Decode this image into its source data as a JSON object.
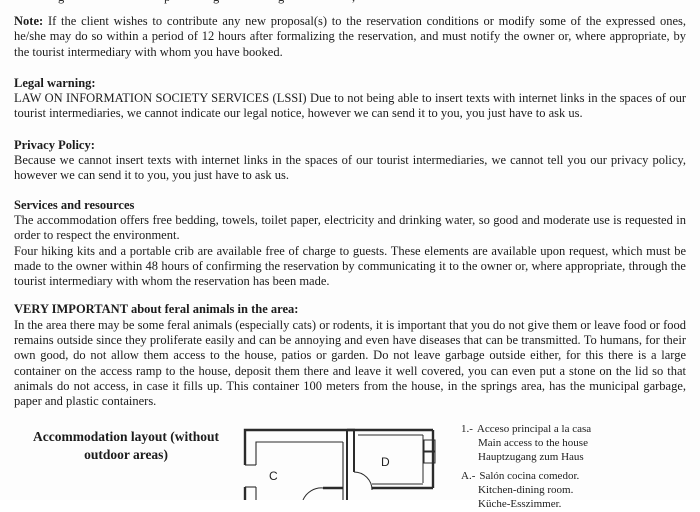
{
  "document": {
    "top_clipped_fragments": [
      "g",
      "p",
      "g",
      "g",
      ","
    ],
    "note": {
      "label": "Note:",
      "text": "If the client wishes to contribute any new proposal(s) to the reservation conditions or modify some of the expressed ones, he/she may do so within a period of 12 hours after formalizing the reservation, and must notify the owner or, where appropriate, by the tourist intermediary with whom you have booked."
    },
    "legal_warning": {
      "heading": "Legal warning:",
      "body": "LAW ON INFORMATION SOCIETY SERVICES (LSSI) Due to not being able to insert texts with internet links in the spaces of our tourist intermediaries, we cannot indicate our legal notice, however we can send it to you, you just have to ask us."
    },
    "privacy_policy": {
      "heading": "Privacy Policy:",
      "body": "Because we cannot insert texts with internet links in the spaces of our tourist intermediaries, we cannot tell you our privacy policy, however we can send it to you, you just have to ask us."
    },
    "services": {
      "heading": "Services and resources",
      "para1": "The accommodation offers free bedding, towels, toilet paper, electricity and drinking water, so good and moderate use is requested in order to respect the environment.",
      "para2": "Four hiking kits and a portable crib are available free of charge to guests. These elements are available upon request, which must be made to the owner within 48 hours of confirming the reservation by communicating it to the owner or, where appropriate, through the tourist intermediary with whom the reservation has been made."
    },
    "feral_animals": {
      "heading": "VERY IMPORTANT about feral animals in the area:",
      "body": "In the area there may be some feral animals (especially cats) or rodents, it is important that you do not give them or leave food or food remains outside since they proliferate easily and can be annoying and even have diseases that can be transmitted. To humans, for their own good, do not allow them access to the house, patios or garden. Do not leave garbage outside either, for this there is a large container on the access ramp to the house, deposit them there and leave it well covered, you can even put a stone on the lid so that animals do not access, in case it fills up. This container 100 meters from the house, in the springs area, has the municipal garbage, paper and plastic containers."
    },
    "layout_section": {
      "heading": "Accommodation layout (without outdoor areas)",
      "floor_plan": {
        "room_labels": {
          "c": "C",
          "d": "D"
        }
      },
      "legend": {
        "items": [
          {
            "key": "1.-",
            "lines": [
              "Acceso principal a la casa",
              "Main access to the house",
              "Hauptzugang zum Haus"
            ]
          },
          {
            "key": "A.-",
            "lines": [
              "Salón cocina comedor.",
              "Kitchen-dining room.",
              "Küche-Esszimmer."
            ]
          }
        ]
      }
    }
  }
}
